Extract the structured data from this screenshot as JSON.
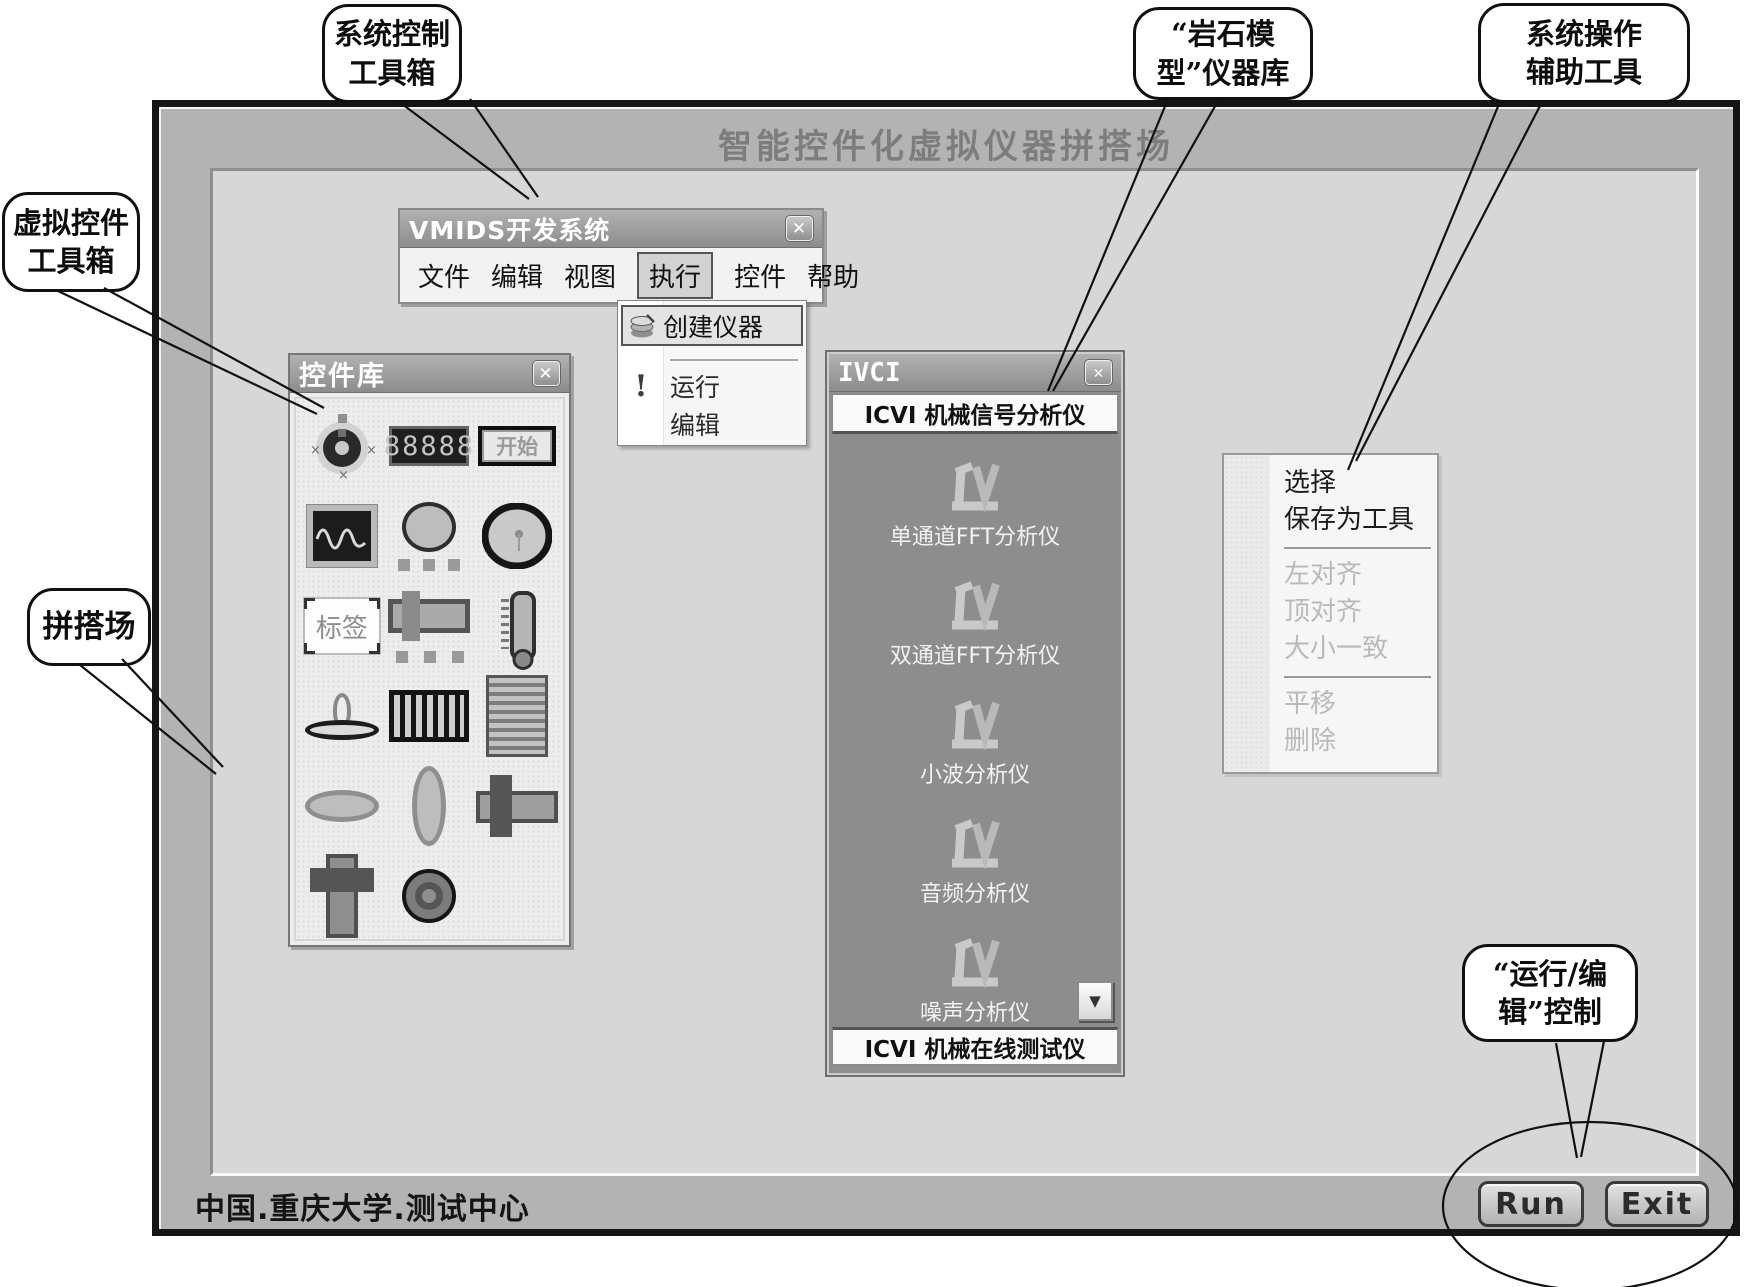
{
  "palette": {
    "window_frame_gray": "#b3b3b3",
    "assembly_field_gray": "#d7d7d7",
    "titlebar_gray": "#9b9b9b",
    "ivci_body_gray": "#8d8d8d",
    "disabled_text_gray": "#b9b9b9",
    "border_black": "#151515"
  },
  "main_window": {
    "title": "智能控件化虚拟仪器拼搭场",
    "footer_text": "中国.重庆大学.测试中心",
    "run_label": "Run",
    "exit_label": "Exit"
  },
  "vmids_window": {
    "title": "VMIDS开发系统",
    "close_icon": "✕",
    "menu_items": [
      "文件",
      "编辑",
      "视图",
      "执行",
      "控件",
      "帮助"
    ],
    "active_menu_item": "执行",
    "dropdown": {
      "create_label": "创建仪器",
      "run_icon": "!",
      "run_label": "运行",
      "edit_label": "编辑"
    }
  },
  "control_library": {
    "title": "控件库",
    "close_icon": "✕",
    "seven_segment_value": "88888",
    "start_button_label": "开始",
    "label_control_text": "标签",
    "icons": [
      "rotary-knob",
      "seven-segment-display",
      "start-button",
      "oscilloscope",
      "round-knob",
      "gauge-meter",
      "text-label",
      "horizontal-slider",
      "thermometer",
      "alcohol-lamp",
      "vertical-grille",
      "horizontal-grille",
      "horizontal-tank",
      "vertical-tank",
      "pipe-cross-horizontal",
      "pipe-cross-vertical",
      "ring-knob"
    ]
  },
  "ivci_window": {
    "title": "IVCI",
    "close_icon": "✕",
    "header_label": "ICVI 机械信号分析仪",
    "footer_label": "ICVI 机械在线测试仪",
    "scroll_icon": "▼",
    "items": [
      "单通道FFT分析仪",
      "双通道FFT分析仪",
      "小波分析仪",
      "音频分析仪",
      "噪声分析仪"
    ]
  },
  "context_menu": {
    "items": [
      {
        "label": "选择",
        "enabled": true
      },
      {
        "label": "保存为工具",
        "enabled": true
      },
      {
        "label": "左对齐",
        "enabled": false
      },
      {
        "label": "顶对齐",
        "enabled": false
      },
      {
        "label": "大小一致",
        "enabled": false
      },
      {
        "label": "平移",
        "enabled": false
      },
      {
        "label": "删除",
        "enabled": false
      }
    ]
  },
  "callouts": [
    {
      "id": "system-control-toolbox",
      "lines": [
        "系统控制",
        "工具箱"
      ]
    },
    {
      "id": "rock-model-instrument-library",
      "lines": [
        "“岩石模",
        "型”仪器库"
      ]
    },
    {
      "id": "system-operation-aux-tools",
      "lines": [
        "系统操作",
        "辅助工具"
      ]
    },
    {
      "id": "virtual-control-toolbox",
      "lines": [
        "虚拟控件",
        "工具箱"
      ]
    },
    {
      "id": "assembly-field",
      "lines": [
        "拼搭场"
      ]
    },
    {
      "id": "run-edit-control",
      "lines": [
        "“运行/编",
        "辑”控制"
      ]
    }
  ]
}
